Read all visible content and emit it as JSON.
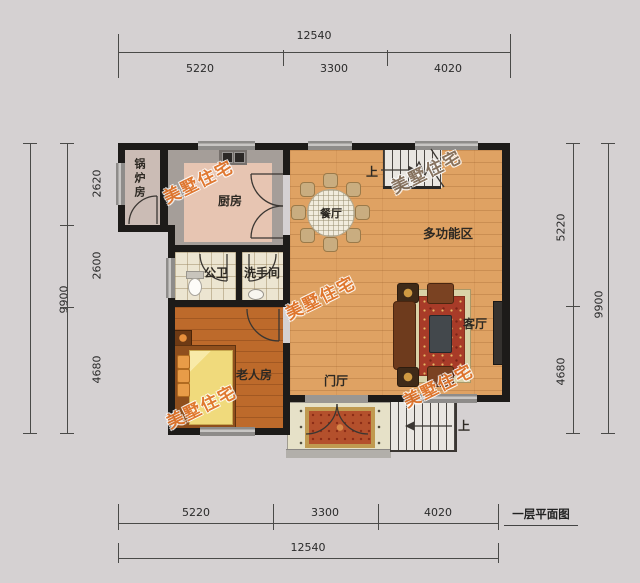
{
  "plan": {
    "title": "一层平面图",
    "watermark": "美墅住宅"
  },
  "dimensions": {
    "top": {
      "total": "12540",
      "segments": [
        "5220",
        "3300",
        "4020"
      ]
    },
    "bottom": {
      "total": "12540",
      "segments": [
        "5220",
        "3300",
        "4020"
      ]
    },
    "left": {
      "total": "9900",
      "segments": [
        "2620",
        "2600",
        "4680"
      ]
    },
    "right": {
      "total": "9900",
      "segments": [
        "5220",
        "4680"
      ]
    }
  },
  "rooms": {
    "boiler": "锅炉房",
    "kitchen": "厨房",
    "dining": "餐厅",
    "multi": "多功能区",
    "bath": "公卫",
    "washroom": "洗手间",
    "elderly": "老人房",
    "living": "客厅",
    "foyer": "门厅"
  },
  "stairs": {
    "up_top": "上",
    "up_bottom": "上"
  },
  "colors": {
    "background": "#d5d1d2",
    "wall": "#1d1b19",
    "wood_floor": "#dfa263",
    "bedroom_floor": "#bd6a2b",
    "kitchen_floor": "#e7c5b2",
    "tile_floor": "#ece5d1",
    "porch_floor": "#e6e1c8",
    "watermark": "#e0742b",
    "carpet": "#a83b28"
  }
}
